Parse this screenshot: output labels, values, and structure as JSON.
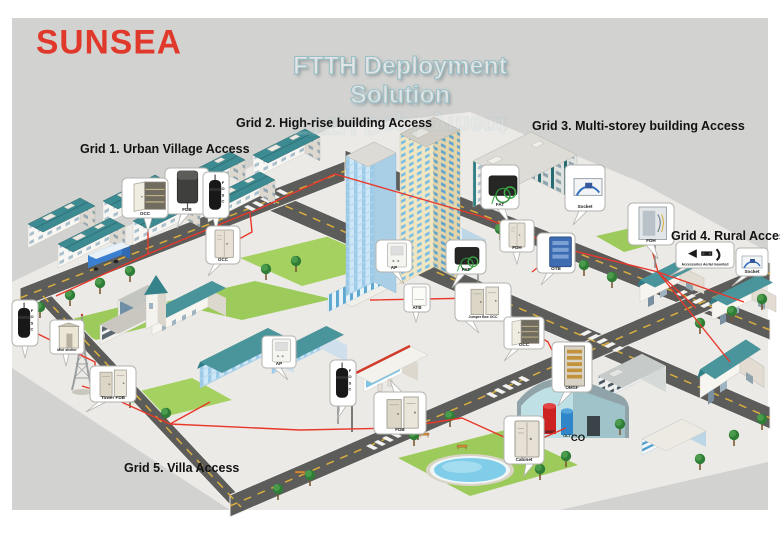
{
  "brand": {
    "logo_text": "SUNSEA"
  },
  "title": "FTTH Deployment Solution",
  "grid_labels": {
    "grid1": "Grid 1. Urban Village Access",
    "grid2": "Grid 2. High-rise building Access",
    "grid3": "Grid 3. Multi-storey building Access",
    "grid4": "Grid 4. Rural Access",
    "grid5": "Grid 5. Villa Access"
  },
  "central_office": {
    "label": "CO",
    "omsf_tank": "OMSF",
    "olt_tank": "OLT"
  },
  "callouts": {
    "g1_fdb": "FDB",
    "g1_occ": "OCC",
    "g1_fosc": "FOSC",
    "g1_occ2": "OCC",
    "g2_ap": "AP",
    "g2_fat": "FAT",
    "g2_atb": "ATB",
    "g2_jumper_occ": "Jumper Box OCC",
    "g3_fat": "FAT",
    "g3_socket": "Socket",
    "g3_fdh": "FDH",
    "g3_otb": "OTB",
    "g4_fdh": "FDH",
    "g4_accessories": "Accessories Aerial mounted",
    "g4_socket": "Socket",
    "g5_fosc": "FOSC",
    "g5_mini_shelter": "Mini shelter",
    "g5_tower_fdb": "Tower FDB",
    "g5_ap": "AP",
    "g5_fosc2": "FOSC",
    "g5_fdb": "FDB",
    "co_occ": "OCC",
    "co_omsf": "OMSF",
    "co_cabinet": "Cabinet"
  },
  "colors": {
    "brand_red": "#e0392c",
    "title_fill": "#e4e4e4",
    "title_outline": "#98bfc6",
    "fiber_line_red": "#e8382a",
    "roof_teal": "#3d8b92",
    "road_gray": "#5c5c5a",
    "background_gray": "#d2d2d0"
  }
}
